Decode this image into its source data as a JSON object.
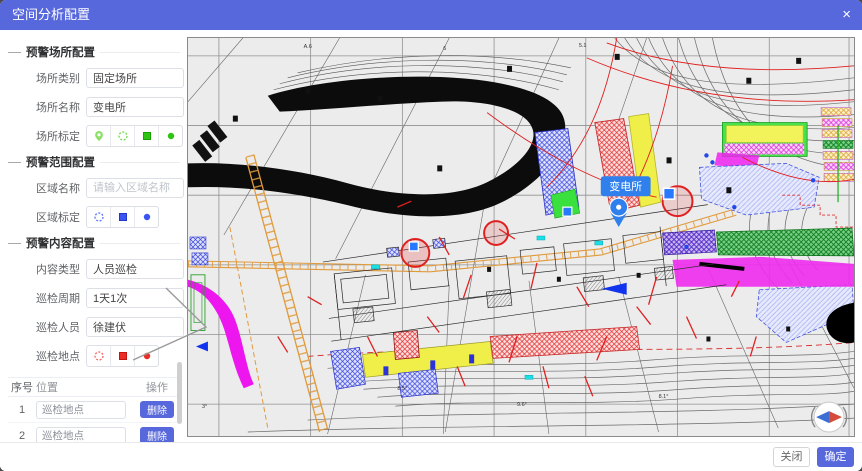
{
  "dialog": {
    "title": "空间分析配置",
    "close": "×"
  },
  "form": {
    "section1": "预警场所配置",
    "section2": "预警范围配置",
    "section3": "预警内容配置",
    "place_type_label": "场所类别",
    "place_type_value": "固定场所",
    "place_name_label": "场所名称",
    "place_name_value": "变电所",
    "place_mark_label": "场所标定",
    "area_name_label": "区域名称",
    "area_name_placeholder": "请输入区域名称",
    "area_mark_label": "区域标定",
    "content_type_label": "内容类型",
    "content_type_value": "人员巡检",
    "cycle_label": "巡检周期",
    "cycle_value": "1天1次",
    "person_label": "巡检人员",
    "person_value": "徐建伏",
    "point_label": "巡检地点"
  },
  "table": {
    "col_index": "序号",
    "col_location": "位置",
    "col_action": "操作",
    "rows": [
      {
        "index": "1",
        "location": "巡检地点",
        "action": "删除"
      },
      {
        "index": "2",
        "location": "巡检地点",
        "action": "删除"
      },
      {
        "index": "3",
        "location": "巡检地点",
        "action": "删除"
      }
    ]
  },
  "map": {
    "tooltip_label": "变电所"
  },
  "footer": {
    "close_label": "关闭",
    "confirm_label": "确定"
  },
  "colors": {
    "header_blue": "#5767dc",
    "marker_green": "#52cc1e",
    "marker_blue": "#4864f0",
    "marker_red": "#f23c3c",
    "map_pin_blue": "#2f80ed"
  }
}
